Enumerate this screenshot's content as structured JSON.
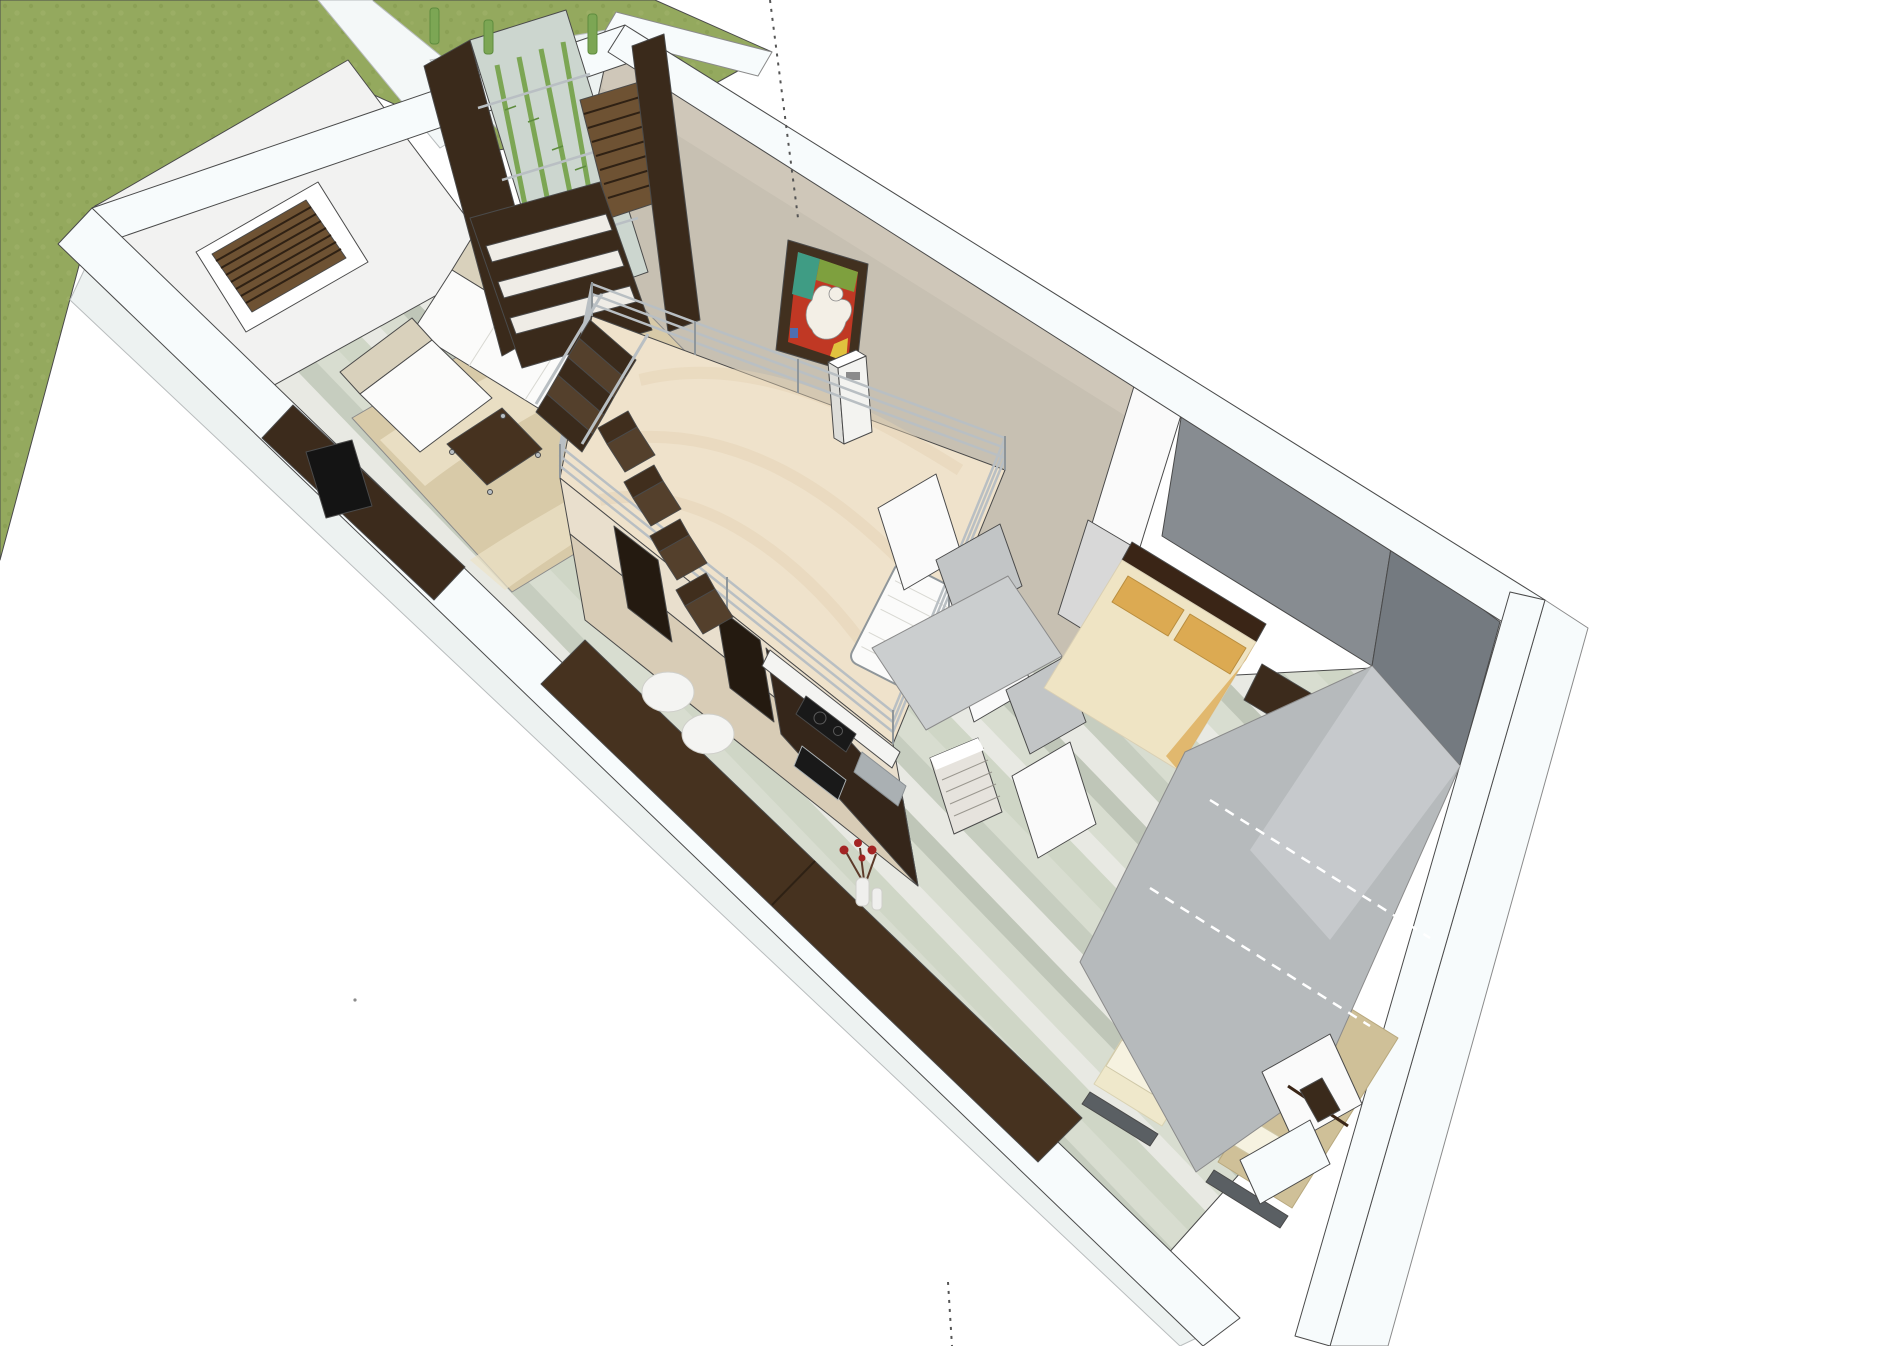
{
  "colors": {
    "bg": "#ffffff",
    "line": "#4a4a4a",
    "softline": "#8b8b8b",
    "grass": "#94a95e",
    "grassDark": "#83994e",
    "grassLight": "#a2b46c",
    "walk": "#f4f8f8",
    "walkEdge": "#b9bdbe",
    "pave": "#edf2f1",
    "bandTop": "#f7fbfc",
    "bandSide": "#c9cdce",
    "wallWhite": "#f2f2f1",
    "wallWhiteShade": "#dcdcda",
    "wallBeige": "#c7c0b2",
    "wallBeigeLight": "#d3ccbe",
    "wallGray": "#878c91",
    "wallGrayDark": "#747a80",
    "roofGray": "#b6babc",
    "roofGrayLight": "#c8cbcd",
    "hallGray": "#cbcecf",
    "floorBase": "#dde1d6",
    "plank1": "#cfd6c6",
    "plank2": "#e8e9e3",
    "plank3": "#bfc6b8",
    "plank4": "#d8ddd0",
    "plank5": "#c6cdbf",
    "rug": "#d8caa8",
    "rugLight": "#ece2c8",
    "sofaWhite": "#fbfbfa",
    "sofaFrame": "#d9d1bc",
    "sofaSeam": "#d8d8d2",
    "tableDark": "#46321f",
    "tableSeam": "#2e2114",
    "chrome": "#b9bfc3",
    "chromeDark": "#8f969a",
    "tv": "#141414",
    "tvCab": "#3c2b1c",
    "wenge": "#3a2a1b",
    "wengeLight": "#54402c",
    "shelf": "#efece6",
    "glass": "#ccd6cf",
    "bamboo": "#7ca654",
    "bambooDark": "#5e8c3e",
    "louver": "#6e5233",
    "louverDark": "#2f2114",
    "frame": "#41301f",
    "artRed": "#c03824",
    "artTeal": "#3f9c84",
    "artGreen": "#7ea03e",
    "artYellow": "#e0c23e",
    "artWhite": "#f3efe6",
    "artBlue": "#4f6eb0",
    "platform": "#efe2cb",
    "platformGrain": "#e4d2b4",
    "cream": "#e9dfcd",
    "creamShade": "#d8ccb6",
    "openingDark": "#241a10",
    "kitchenDark": "#35261a",
    "counter": "#f4f4f2",
    "cooktop": "#191919",
    "burner": "#5a5a5a",
    "steel": "#aab0b3",
    "steelDark": "#8a9094",
    "chair": "#402e1d",
    "stool": "#f4f4f2",
    "stoolEdge": "#cfcfca",
    "vase": "#efefed",
    "flower": "#a32424",
    "stem": "#5d3a2a",
    "bedFrame": "#3a2516",
    "pillowGold": "#dcaa52",
    "pillowGoldEdge": "#b98d3e",
    "duvetCream": "#efe4c4",
    "duvetEdge": "#d9cfb4",
    "bedA": "#efe8cb",
    "bedAEdge": "#d9d2b2",
    "bedB": "#cfc098",
    "bedBEdge": "#b8a87e",
    "pillowWhite": "#f6f2e0",
    "pillowWhiteEdge": "#cfc8a8",
    "headGray": "#5a5f63",
    "doorWhite": "#fafafa",
    "doorShade": "#d8d8d8",
    "partGray": "#c2c5c6",
    "applGray": "#e6e3dd",
    "applSlat": "#9a978f",
    "dash": "#555555",
    "dashWhite": "#ffffff",
    "vent": "#f3f3f0",
    "ventSide": "#dededa"
  }
}
